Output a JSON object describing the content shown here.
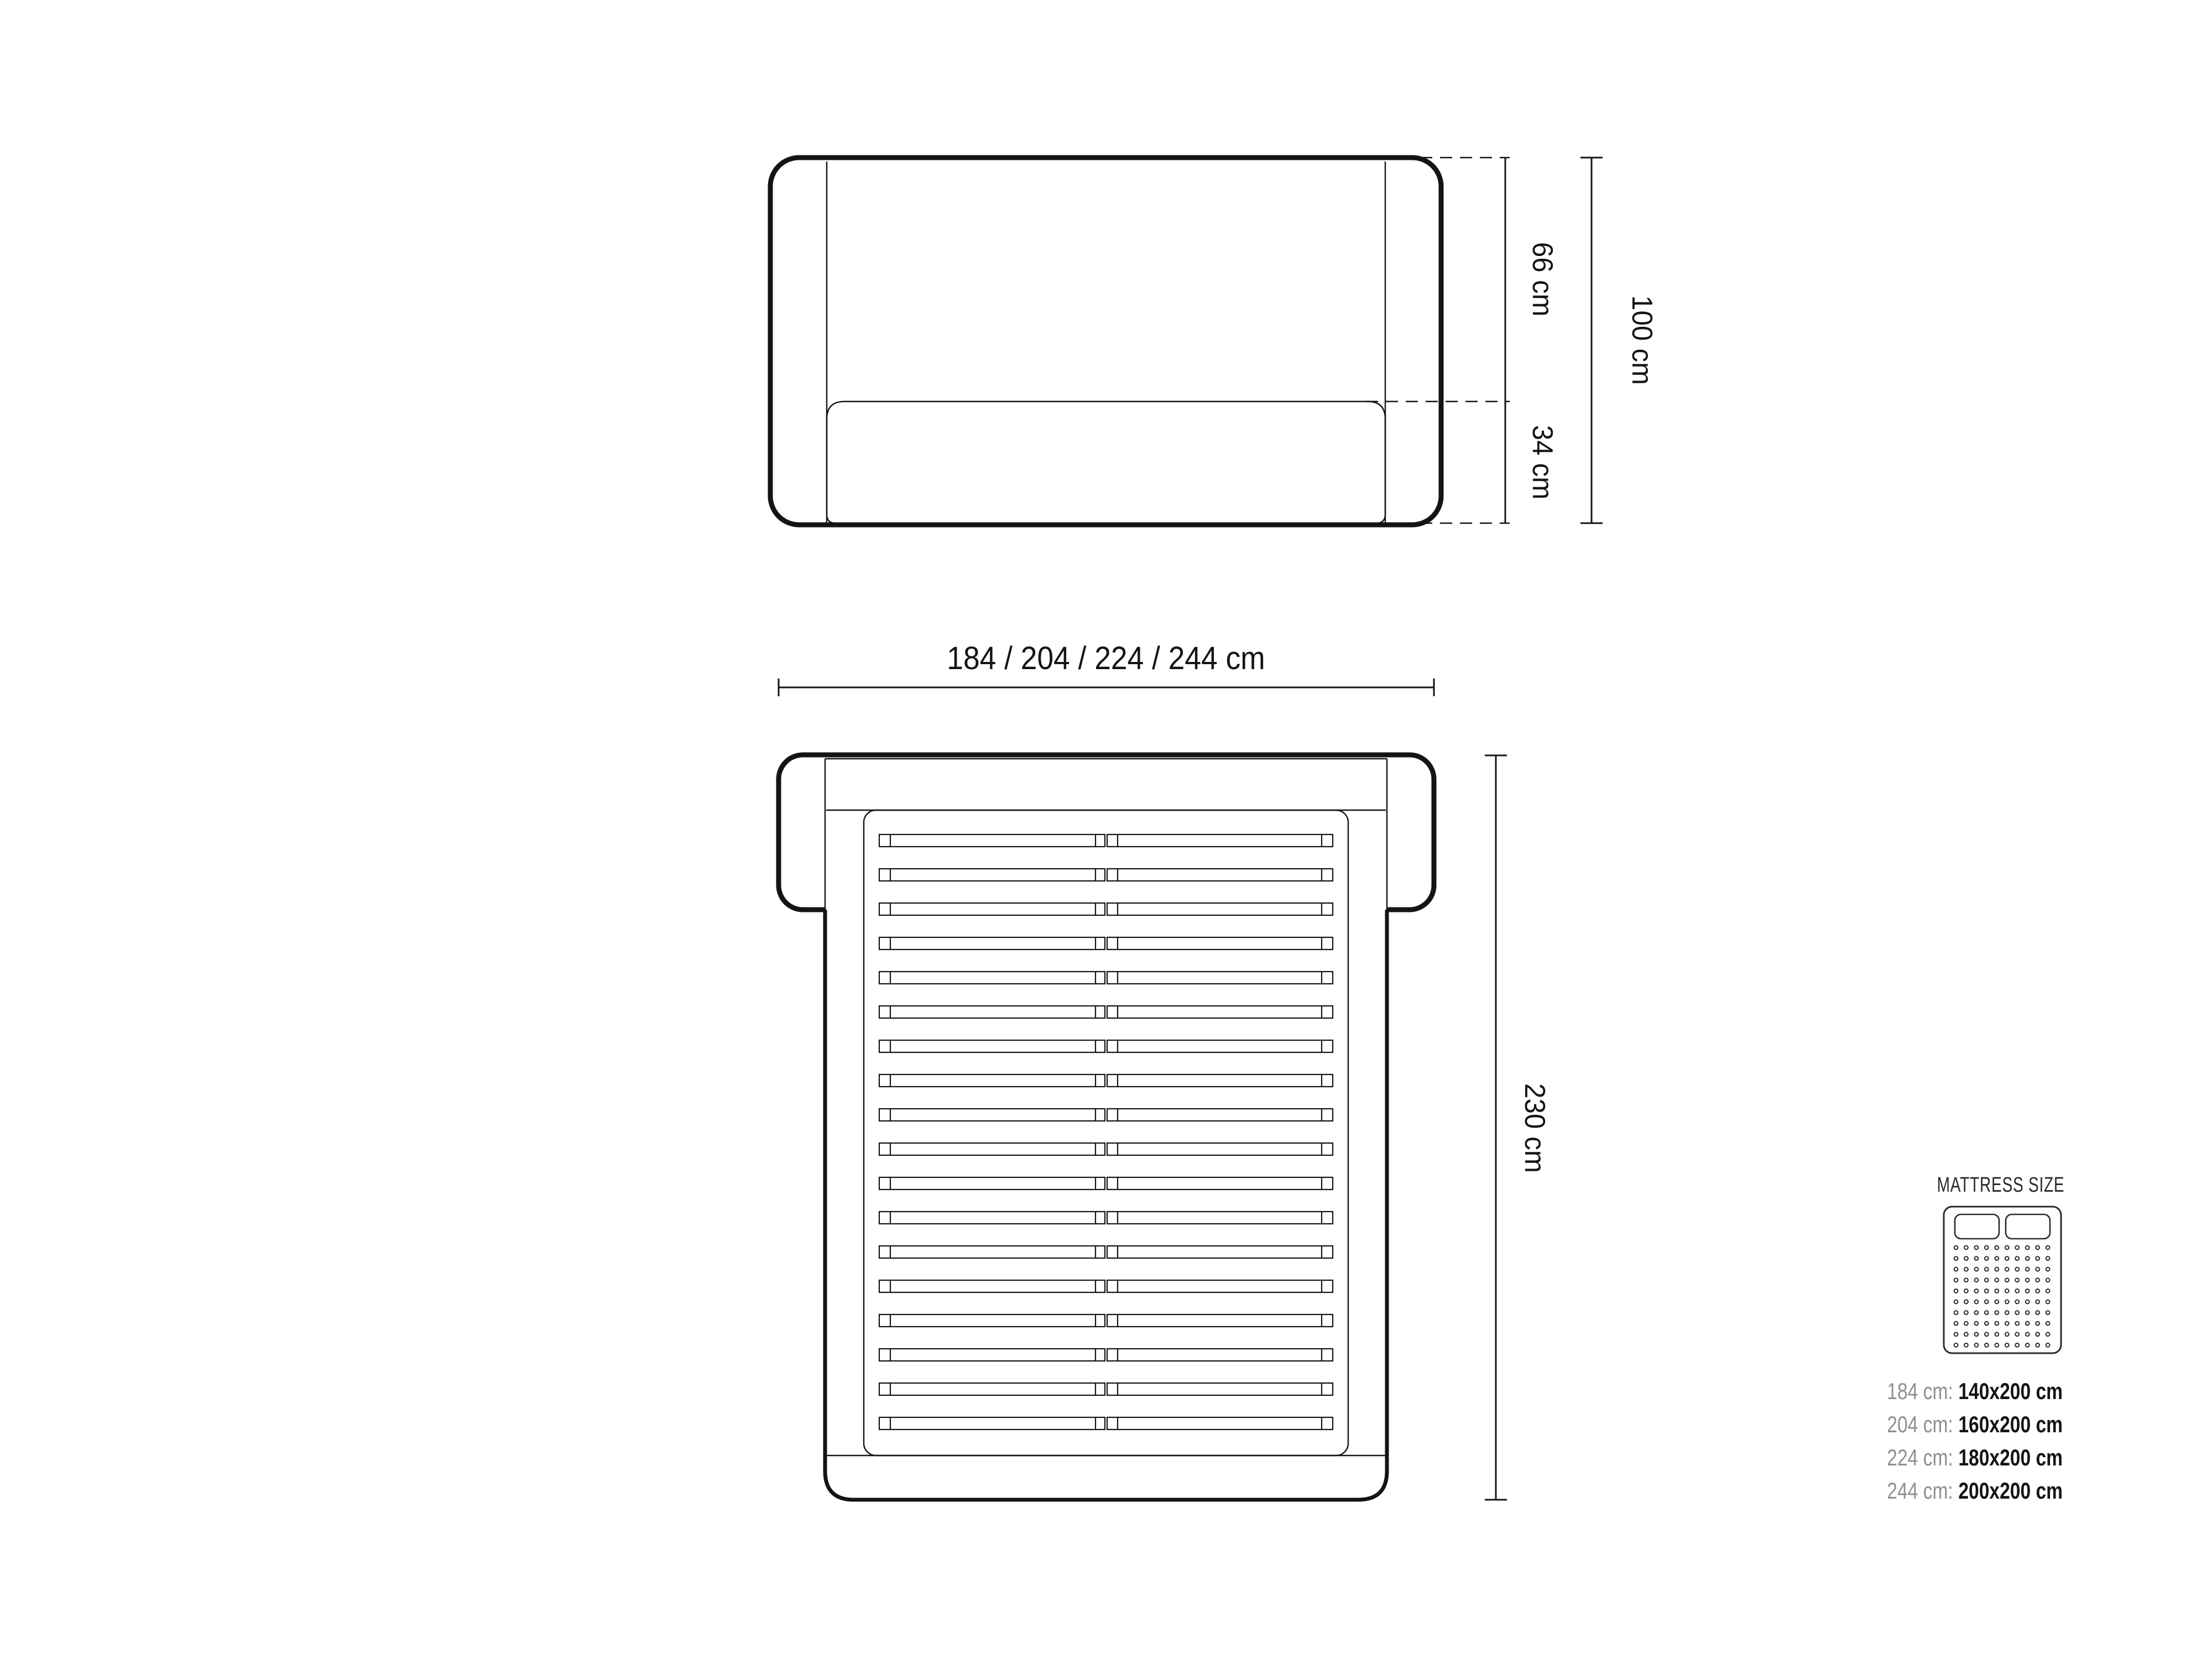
{
  "colors": {
    "background": "#ffffff",
    "ink": "#141414",
    "muted_label": "#8f8f8f"
  },
  "front_view": {
    "upper_height": "66 cm",
    "lower_height": "34 cm",
    "total_height": "100 cm"
  },
  "plan_view": {
    "width_options": "184 / 204 / 224 / 244 cm",
    "length": "230 cm",
    "slat_count": 18
  },
  "mattress_panel": {
    "title": "MATTRESS SIZE",
    "dot_rows": 10,
    "dot_cols": 10,
    "rows": [
      {
        "frame_width": "184 cm:",
        "mattress_size": "140x200 cm"
      },
      {
        "frame_width": "204 cm:",
        "mattress_size": "160x200 cm"
      },
      {
        "frame_width": "224 cm:",
        "mattress_size": "180x200 cm"
      },
      {
        "frame_width": "244 cm:",
        "mattress_size": "200x200 cm"
      }
    ]
  }
}
